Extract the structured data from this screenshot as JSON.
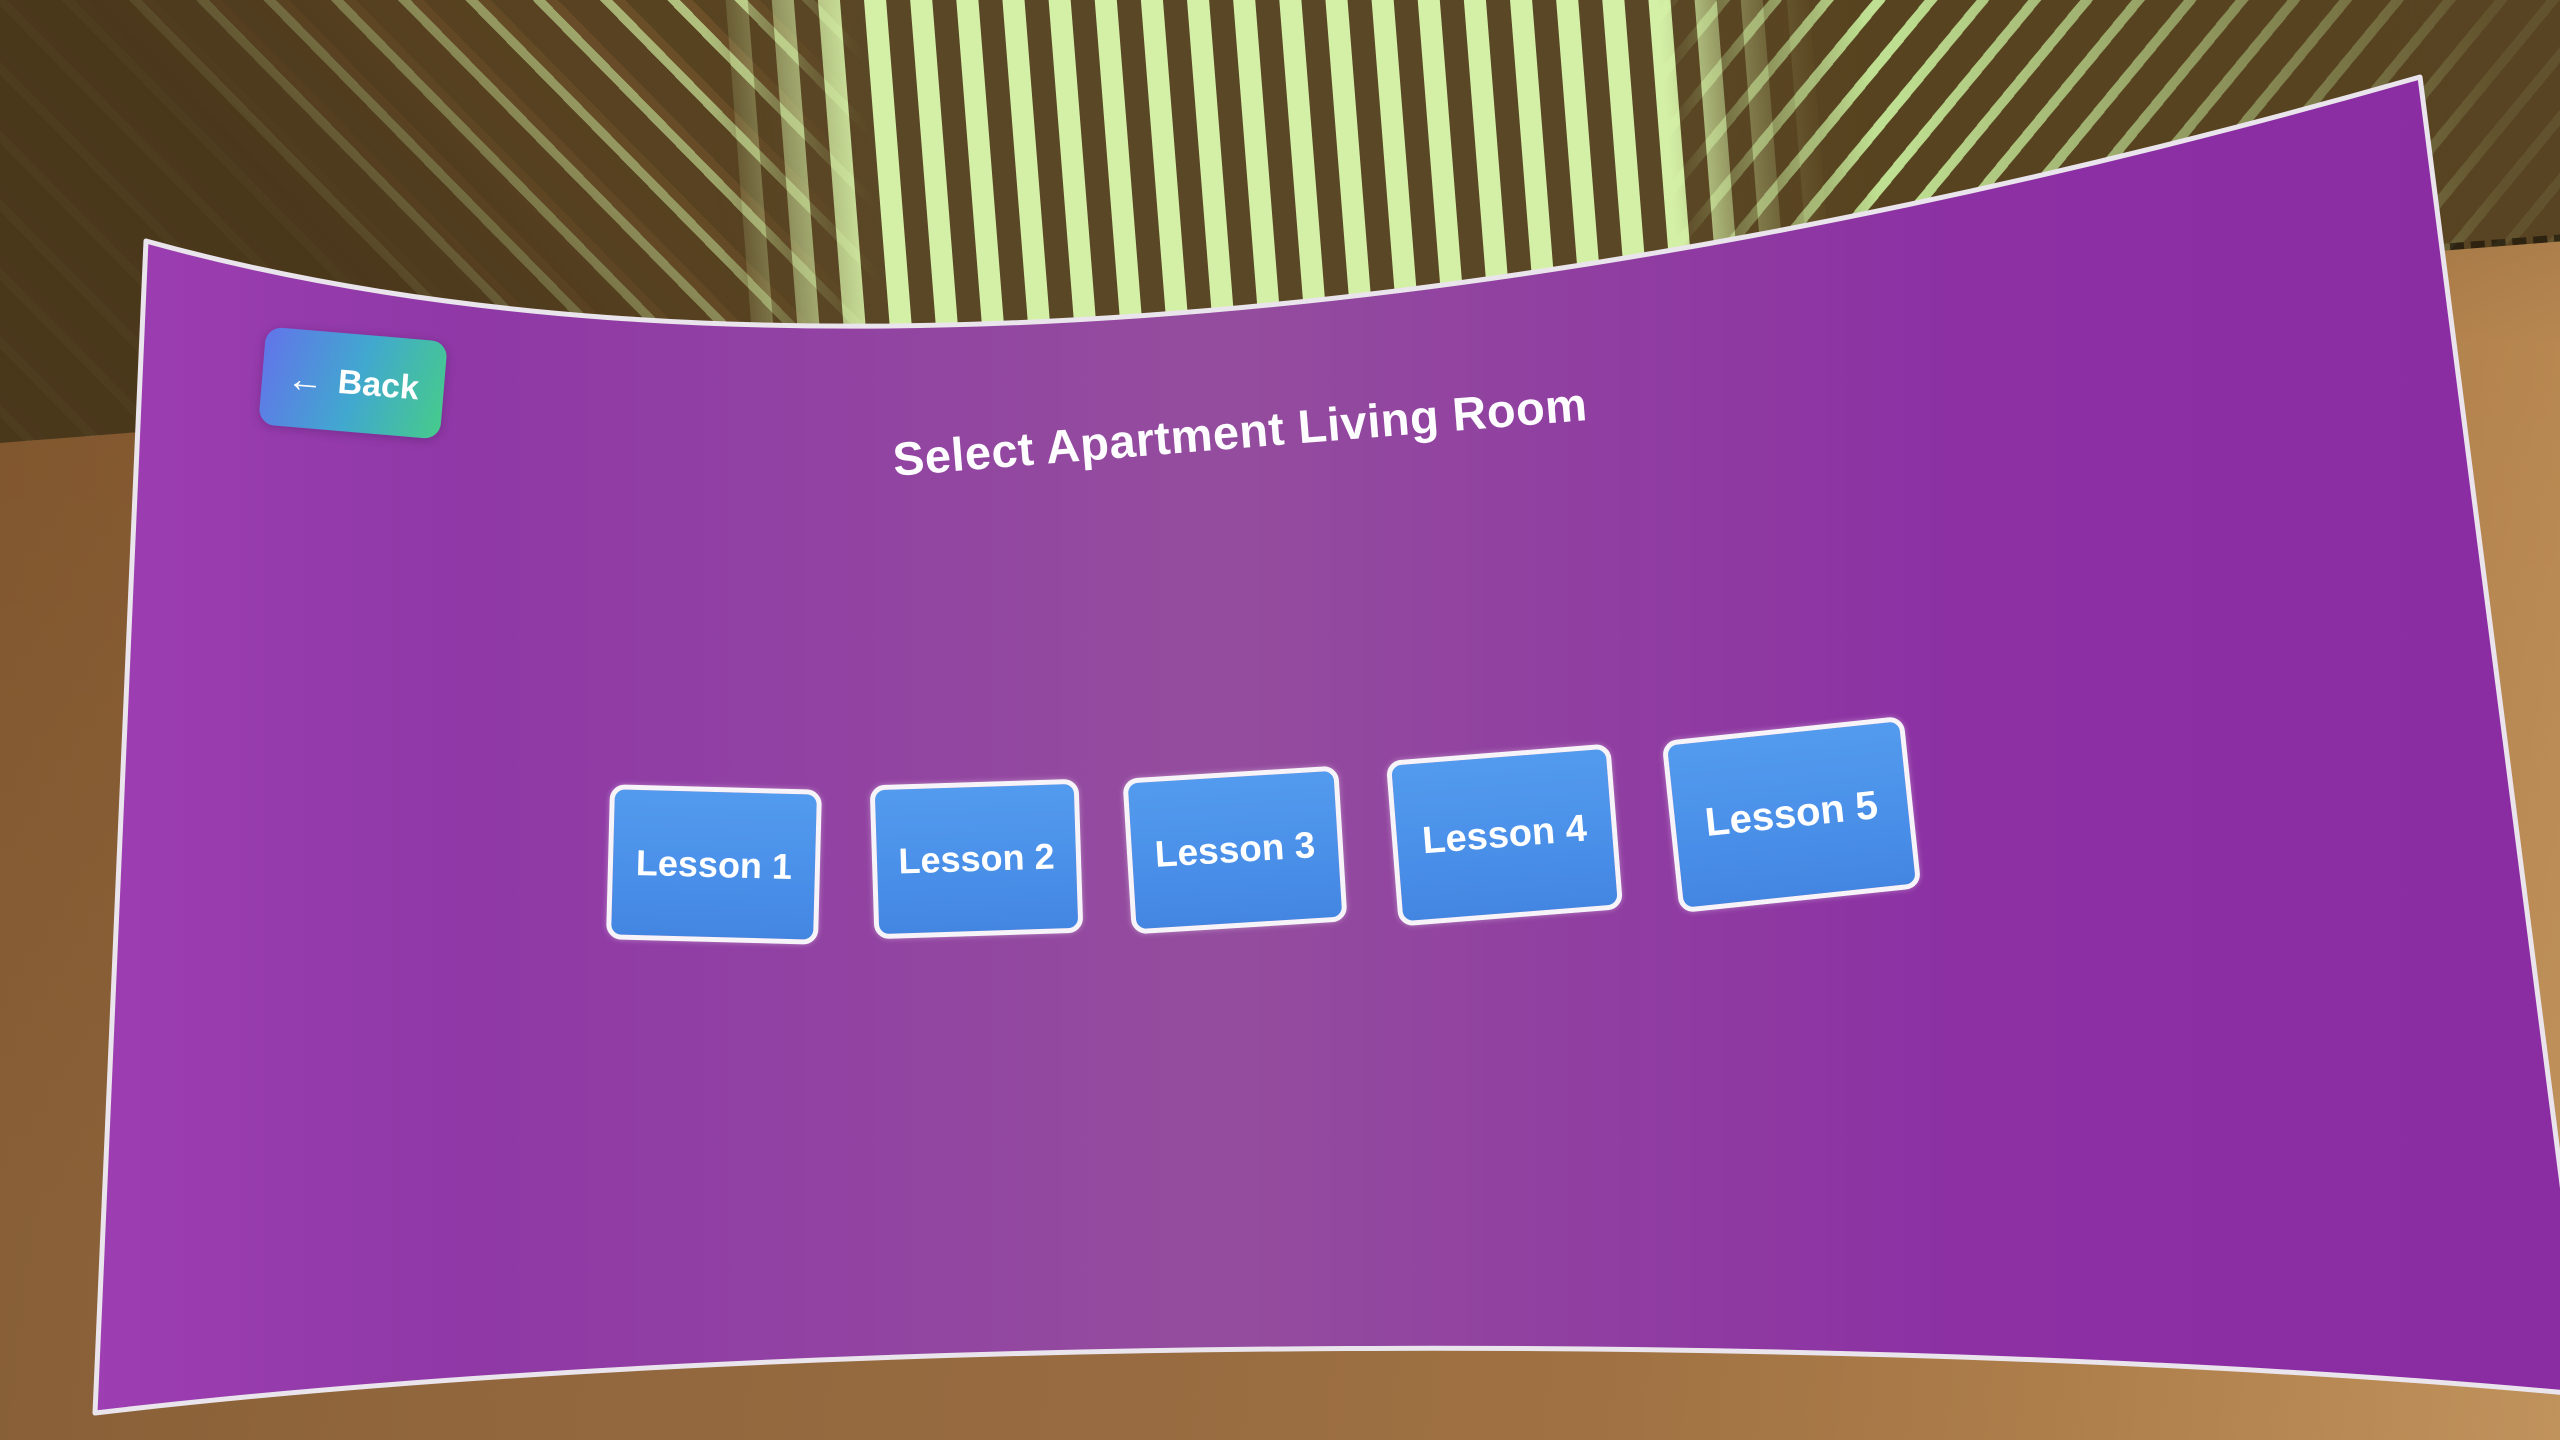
{
  "panel": {
    "title": "Select Apartment Living Room",
    "back_button": {
      "arrow": "←",
      "label": "Back"
    },
    "lessons": [
      {
        "label": "Lesson 1"
      },
      {
        "label": "Lesson 2"
      },
      {
        "label": "Lesson 3"
      },
      {
        "label": "Lesson 4"
      },
      {
        "label": "Lesson 5"
      }
    ],
    "colors": {
      "panel_purple": "#8f3ba4",
      "panel_border_white": "#eae4ec",
      "lesson_button_blue": "#4a90e9",
      "lesson_button_border": "#f6f4f9",
      "back_gradient_start": "#6274ea",
      "back_gradient_end": "#46cb8b",
      "text": "#ffffff"
    }
  },
  "environment": {
    "ceiling_light_green": "#d4f0a6",
    "wood_slat_brown": "#5a4725",
    "wall_brown": "#97683a"
  }
}
